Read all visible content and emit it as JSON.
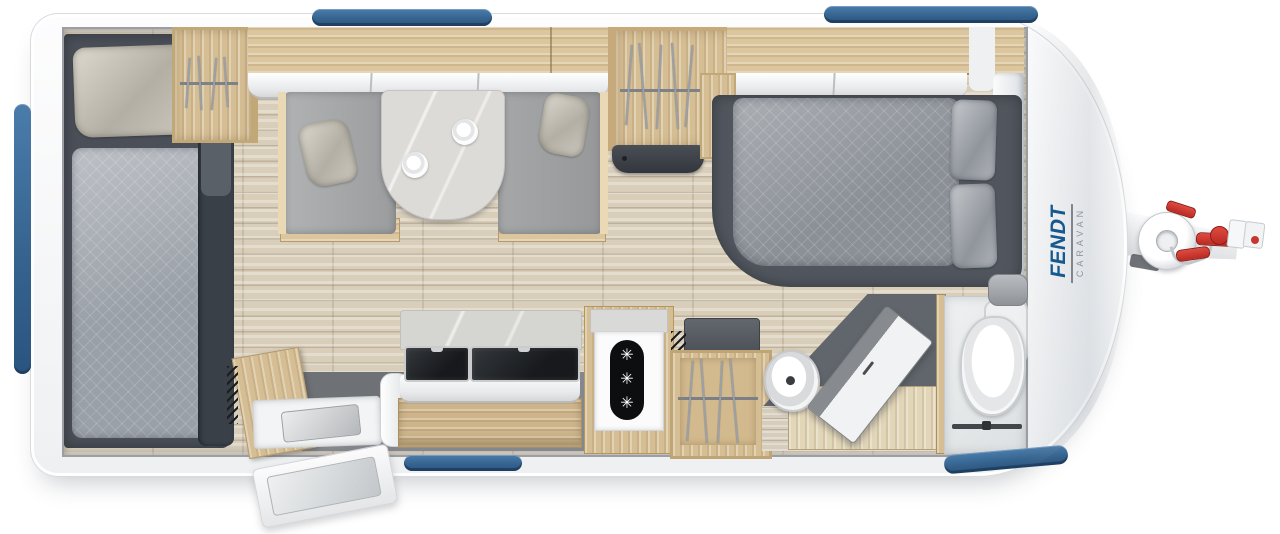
{
  "brand": {
    "name": "FENDT",
    "subtitle": "CARAVAN"
  },
  "icons": {
    "freezer_symbol": "✳",
    "freezer_symbol_count": 3,
    "hanger_icon": "wire-hangers",
    "cup_icon": "top-view-cup"
  },
  "colors": {
    "window_accent_blue": "#36648f",
    "brand_blue": "#15598f",
    "brand_gray": "#8f959b",
    "hitch_red": "#c9362d",
    "body_white": "#f6f7f8",
    "cabinet_wood": "#d6be94",
    "floor_wood": "#d9ceba",
    "upholstery_gray": "#9aa1a9",
    "base_dark_gray": "#4a4f58"
  }
}
